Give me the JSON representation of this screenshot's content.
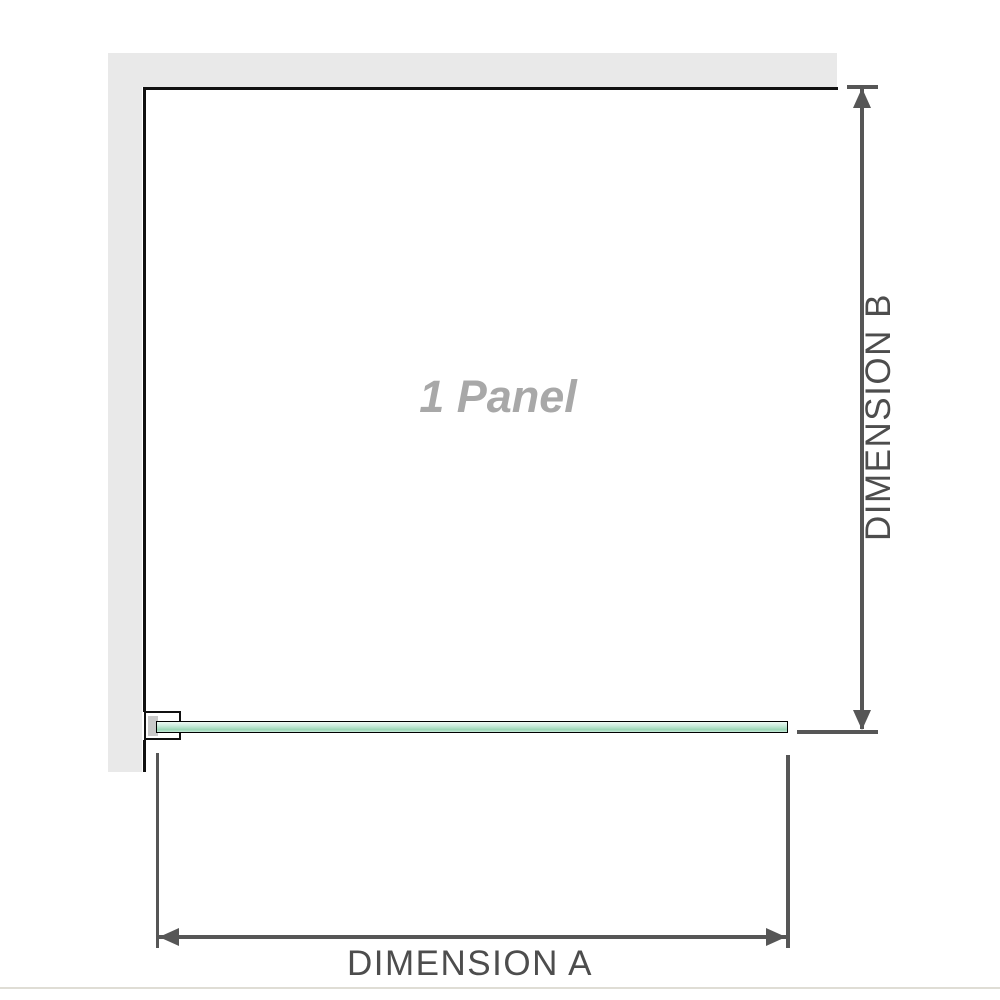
{
  "labels": {
    "panel": "1 Panel",
    "dimension_a": "DIMENSION A",
    "dimension_b": "DIMENSION B"
  },
  "colors": {
    "wall": "#e9e9e9",
    "outline": "#111111",
    "dimension": "#565656",
    "dim_label": "#4d4d4d",
    "panel_label": "#a8a8a8",
    "glass_border": "#000000",
    "glass_top": "#eef9f3",
    "glass_mid": "#c9ebdb",
    "glass_deep": "#9ad6b5",
    "clamp_pad": "#c9c9c9",
    "rule": "#dfddd5",
    "background": "#ffffff"
  }
}
